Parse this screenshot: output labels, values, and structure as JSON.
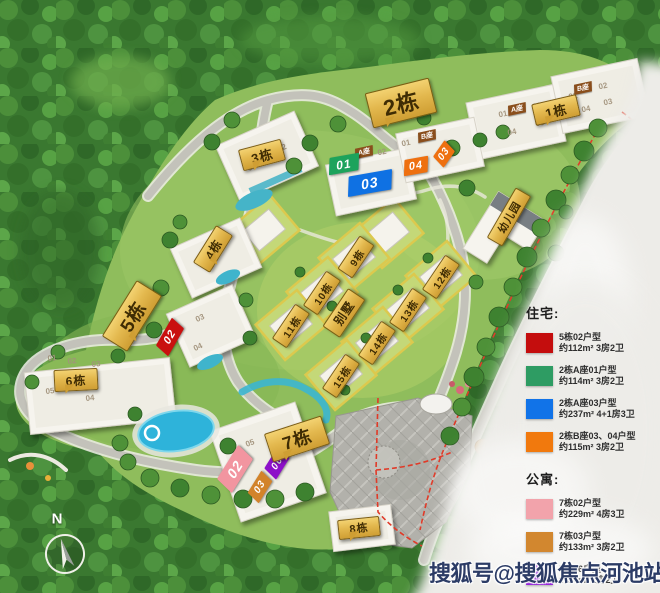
{
  "map": {
    "banners": {
      "b1": "1栋",
      "b2": "2栋",
      "b3": "3栋",
      "b4": "4栋",
      "b5": "5栋",
      "b6": "6栋",
      "b7": "7栋",
      "b8": "8栋",
      "b9": "9栋",
      "b10": "10栋",
      "b11": "11栋",
      "b12": "12栋",
      "b13": "13栋",
      "b14": "14栋",
      "b15": "15栋",
      "villa": "别墅",
      "kindergarten": "幼儿园"
    },
    "unit_tags": [
      {
        "label": "01",
        "color": "#1da35c"
      },
      {
        "label": "03",
        "color": "#0f71e3"
      },
      {
        "label": "04",
        "color": "#ee7010"
      },
      {
        "label": "03",
        "color": "#ee7010"
      },
      {
        "label": "02",
        "color": "#c9100f"
      },
      {
        "label": "02",
        "color": "#f295a0"
      },
      {
        "label": "03",
        "color": "#d2832a"
      },
      {
        "label": "06",
        "color": "#8d10c9"
      }
    ],
    "block_tags": [
      "A座",
      "B座",
      "A座",
      "B座"
    ],
    "faint_units": [
      "01",
      "02",
      "03",
      "04",
      "01",
      "02",
      "03",
      "04",
      "01",
      "02",
      "01",
      "02",
      "01",
      "03",
      "04",
      "01",
      "02",
      "03",
      "05",
      "04",
      "01",
      "05"
    ],
    "compass_n": "N"
  },
  "legend": {
    "sections": [
      {
        "title": "住宅:",
        "items": [
          {
            "color": "#c40d0d",
            "name": "5栋02户型",
            "desc": "约112m² 3房2卫"
          },
          {
            "color": "#2e9c63",
            "name": "2栋A座01户型",
            "desc": "约114m² 3房2卫"
          },
          {
            "color": "#1173e8",
            "name": "2栋A座03户型",
            "desc": "约237m² 4+1房3卫"
          },
          {
            "color": "#f1790d",
            "name": "2栋B座03、04户型",
            "desc": "约115m² 3房2卫"
          }
        ]
      },
      {
        "title": "公寓:",
        "items": [
          {
            "color": "#f2a3ab",
            "name": "7栋02户型",
            "desc": "约229m² 4房3卫"
          },
          {
            "color": "#d2872f",
            "name": "7栋03户型",
            "desc": "约133m² 3房2卫"
          },
          {
            "color": "#8a0ed6",
            "name": "7栋06户型",
            "desc": "约94m² 2房2卫"
          }
        ]
      }
    ]
  },
  "watermark": "搜狐号@搜狐焦点河池站"
}
